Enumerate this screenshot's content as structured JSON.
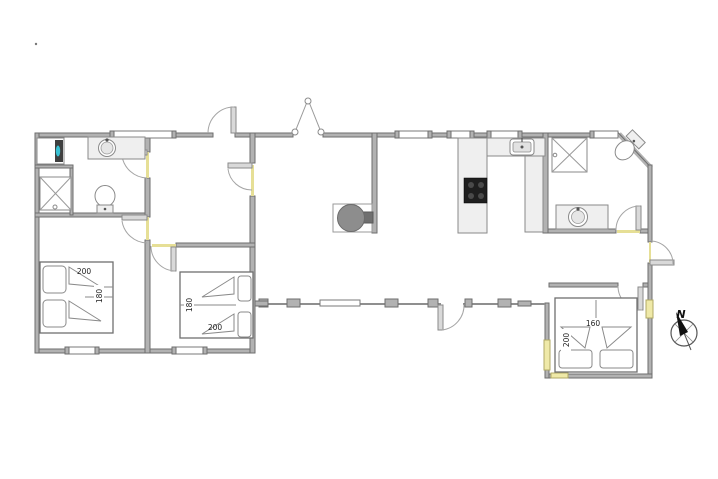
{
  "plan": {
    "compass": {
      "north_label": "N"
    },
    "beds": {
      "bedroom1": {
        "length_label": "200",
        "width_label": "180"
      },
      "bedroom2": {
        "width_label": "180",
        "length_label": "200"
      },
      "bedroom3": {
        "width_label": "160",
        "length_label": "200"
      }
    },
    "colors": {
      "wall_fill": "#b2b2b2",
      "wall_outline": "#6e6e6e",
      "fixture_fill": "#efefef",
      "threshold_yellow": "#e6df96",
      "cooktop_black": "#1f1f1f",
      "washer_accent": "#39c2d4",
      "stove_gray": "#8d8d8d"
    },
    "fixtures": [
      "washing-machine",
      "shower-cabin",
      "toilet",
      "washbasin-counter",
      "kitchen-sink",
      "cooktop",
      "wood-stove",
      "double-bed",
      "compass-rose"
    ]
  }
}
